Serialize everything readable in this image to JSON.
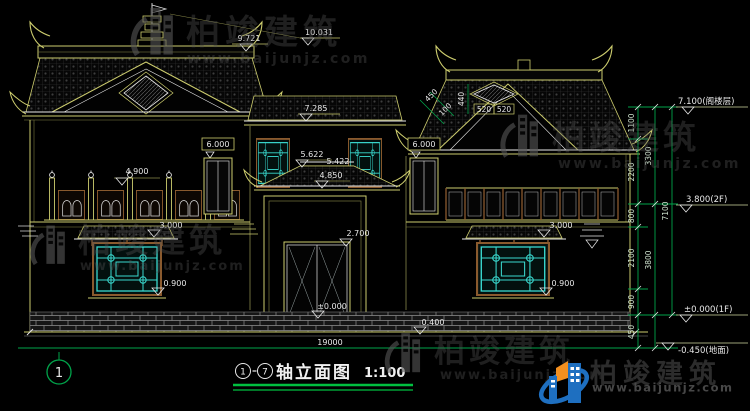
{
  "brand": {
    "name": "柏竣建筑",
    "url": "www.baijunjz.com"
  },
  "title": {
    "axis_from": "1",
    "axis_to": "7",
    "name": "轴立面图",
    "scale": "1:100"
  },
  "axis_bubble": "1",
  "dims": {
    "finial_top": "10.031",
    "ridge": "9.721",
    "center_eave": "7.285",
    "window_left": "6.000",
    "window_right": "6.000",
    "mid_upper": "5.622",
    "mid_lower": "5.422",
    "canopy": "4.850",
    "railing": "4.900",
    "awning_left": "3.000",
    "awning_right": "3.000",
    "door": "2.700",
    "sill_left": "0.900",
    "sill_right": "0.900",
    "plinth": "0.400",
    "floor_zero": "±0.000",
    "total_width": "19000",
    "gable_seg_a": "520",
    "gable_seg_b": "520",
    "gable_height": "440",
    "slope_a": "450",
    "slope_b": "100"
  },
  "levels": {
    "attic": "7.100(阁楼层)",
    "f2": "3.800(2F)",
    "f1": "±0.000(1F)",
    "ground": "-0.450(地面)"
  },
  "chain": {
    "s1": "1100",
    "s2": "2200",
    "s3": "800",
    "s4": "2100",
    "s5": "900",
    "s6": "450",
    "m1": "3300",
    "m2": "3800",
    "total": "7100"
  },
  "colors": {
    "background": "#000000",
    "line_yellow": "#cdcd6e",
    "line_white": "#e8e8e8",
    "lattice_cyan": "#3ad9cf",
    "dim_green": "#00a34a",
    "frame_brown": "#8a5a2e",
    "watermark_gray": "#585858",
    "logo_blue": "#1e6fc0",
    "logo_orange": "#f39020"
  }
}
